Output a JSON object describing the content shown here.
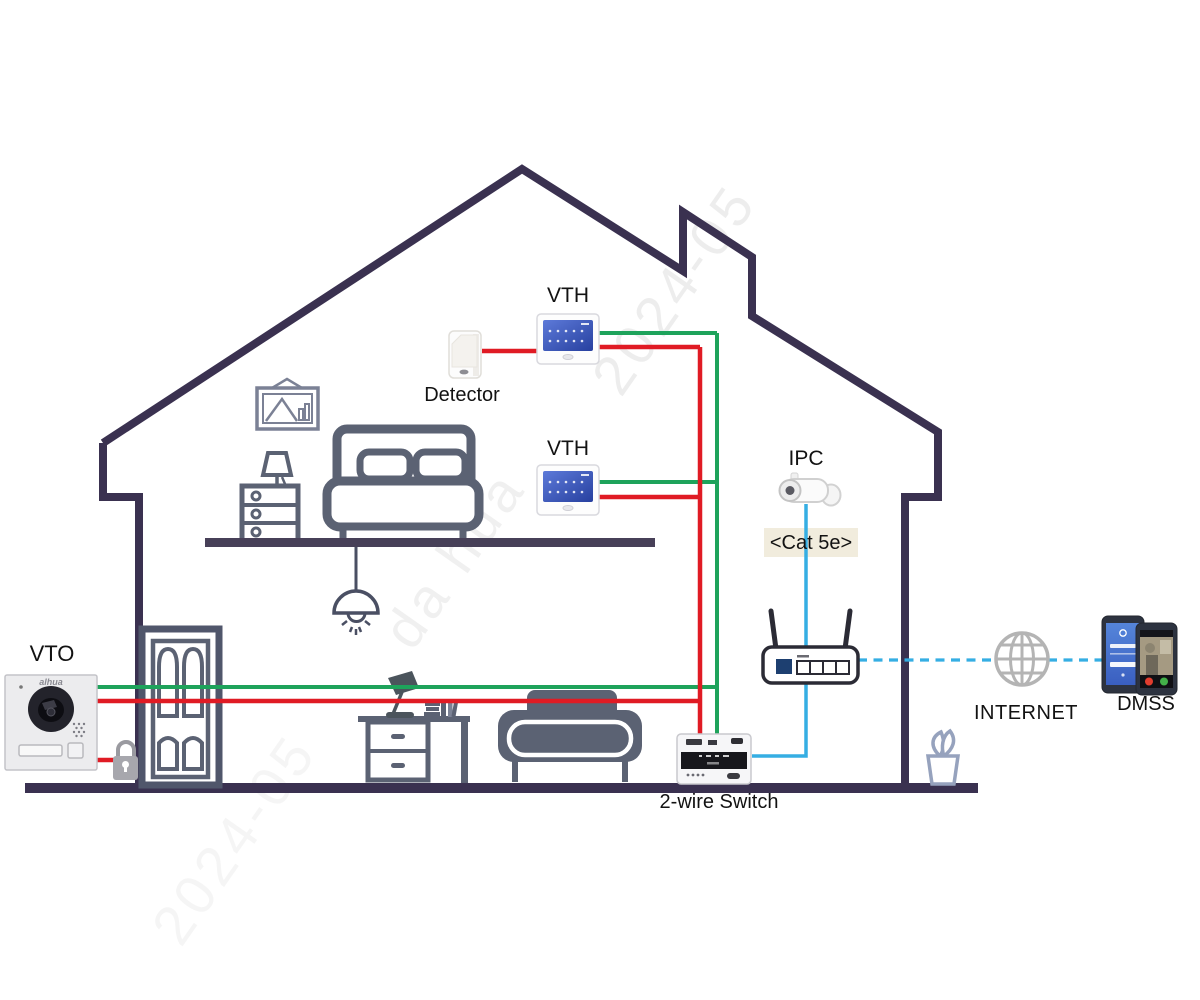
{
  "labels": {
    "vto": "VTO",
    "vth_upper": "VTH",
    "vth_lower": "VTH",
    "detector": "Detector",
    "ipc": "IPC",
    "cat5e": "<Cat 5e>",
    "two_wire_switch": "2-wire Switch",
    "internet": "INTERNET",
    "dmss": "DMSS",
    "vto_brand": "alhua"
  },
  "watermarks": {
    "date": "2024-05",
    "brand": "da hua"
  },
  "colors": {
    "house_outline": "#3a3150",
    "furniture": "#5b6273",
    "wire_red": "#e01b24",
    "wire_green": "#1ea35b",
    "wire_cyan": "#35aee3",
    "label_text": "#121212",
    "cat5e_bg": "#f1ecdd",
    "globe": "#b4b4b4"
  }
}
